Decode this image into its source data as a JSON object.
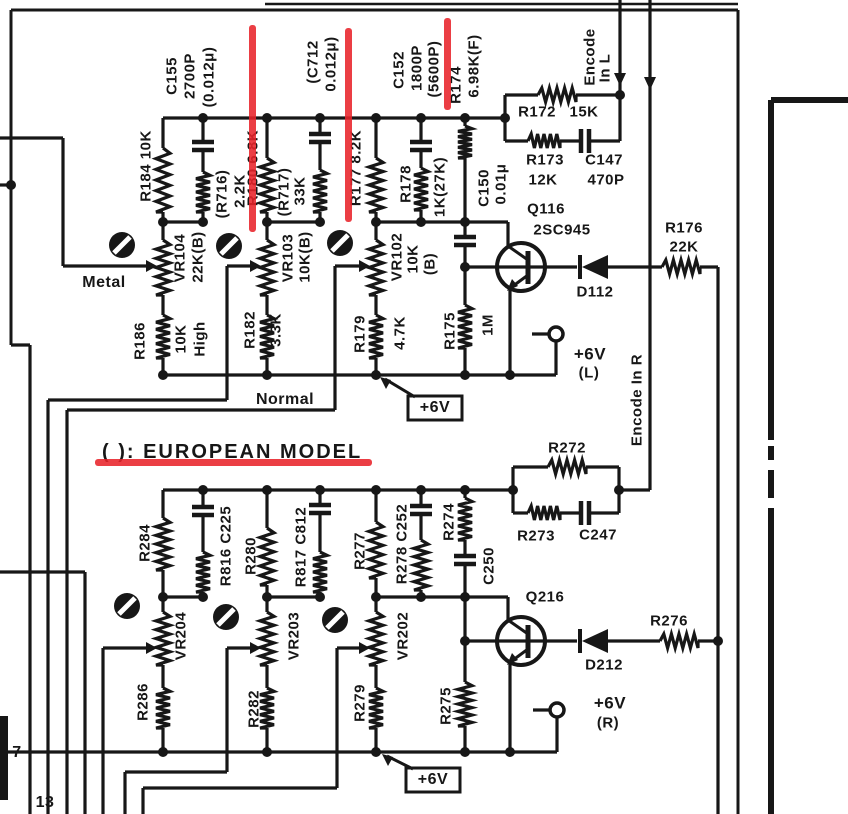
{
  "colors": {
    "ink": "#171717",
    "paper": "#ffffff",
    "annotation": "#e8232a"
  },
  "note": "( ): EUROPEAN MODEL",
  "channel_left": {
    "transistor": "Q116 2SC945",
    "diode": "D112",
    "supply": "+6V (L)",
    "encode_line": "Encode In L",
    "selector_positions": [
      "Metal",
      "High",
      "Normal"
    ]
  },
  "channel_right": {
    "transistor": "Q216",
    "diode": "D212",
    "supply": "+6V (R)",
    "encode_line": "Encode In R"
  },
  "pins": [
    "7",
    "13"
  ],
  "labels": [
    {
      "t": "C155",
      "x": 172,
      "y": 76,
      "r": -90,
      "s": 15
    },
    {
      "t": "2700P",
      "x": 190,
      "y": 76,
      "r": -90,
      "s": 15
    },
    {
      "t": "(0.012μ)",
      "x": 209,
      "y": 77,
      "r": -90,
      "s": 15
    },
    {
      "t": "R184 10K",
      "x": 146,
      "y": 166,
      "r": -90,
      "s": 15
    },
    {
      "t": "(R716)",
      "x": 222,
      "y": 194,
      "r": -90,
      "s": 15
    },
    {
      "t": "2.2K",
      "x": 240,
      "y": 191,
      "r": -90,
      "s": 15
    },
    {
      "t": "R180 6.8K",
      "x": 253,
      "y": 168,
      "r": -90,
      "s": 15
    },
    {
      "t": "(R717)",
      "x": 284,
      "y": 192,
      "r": -90,
      "s": 15
    },
    {
      "t": "33K",
      "x": 300,
      "y": 191,
      "r": -90,
      "s": 15
    },
    {
      "t": "(C712",
      "x": 313,
      "y": 62,
      "r": -90,
      "s": 15
    },
    {
      "t": "0.012μ)",
      "x": 331,
      "y": 64,
      "r": -90,
      "s": 15
    },
    {
      "t": "R177 8.2K",
      "x": 356,
      "y": 168,
      "r": -90,
      "s": 15
    },
    {
      "t": "C152",
      "x": 399,
      "y": 70,
      "r": -90,
      "s": 15
    },
    {
      "t": "1800P",
      "x": 417,
      "y": 68,
      "r": -90,
      "s": 15
    },
    {
      "t": "(5600P)",
      "x": 434,
      "y": 69,
      "r": -90,
      "s": 15
    },
    {
      "t": "R174",
      "x": 456,
      "y": 85,
      "r": -90,
      "s": 15
    },
    {
      "t": "6.98K(F)",
      "x": 474,
      "y": 66,
      "r": -90,
      "s": 15
    },
    {
      "t": "R178",
      "x": 406,
      "y": 184,
      "r": -90,
      "s": 15
    },
    {
      "t": "1K(27K)",
      "x": 440,
      "y": 187,
      "r": -90,
      "s": 15
    },
    {
      "t": "C150",
      "x": 484,
      "y": 188,
      "r": -90,
      "s": 15
    },
    {
      "t": "0.01μ",
      "x": 501,
      "y": 184,
      "r": -90,
      "s": 15
    },
    {
      "t": "VR104",
      "x": 180,
      "y": 258,
      "r": -90,
      "s": 15
    },
    {
      "t": "22K(B)",
      "x": 198,
      "y": 257,
      "r": -90,
      "s": 15
    },
    {
      "t": "VR103",
      "x": 288,
      "y": 258,
      "r": -90,
      "s": 15
    },
    {
      "t": "10K(B)",
      "x": 305,
      "y": 257,
      "r": -90,
      "s": 15
    },
    {
      "t": "VR102",
      "x": 397,
      "y": 257,
      "r": -90,
      "s": 15
    },
    {
      "t": "10K",
      "x": 413,
      "y": 259,
      "r": -90,
      "s": 15
    },
    {
      "t": "(B)",
      "x": 430,
      "y": 264,
      "r": -90,
      "s": 15
    },
    {
      "t": "R186",
      "x": 140,
      "y": 341,
      "r": -90,
      "s": 15
    },
    {
      "t": "10K",
      "x": 181,
      "y": 339,
      "r": -90,
      "s": 15
    },
    {
      "t": "High",
      "x": 200,
      "y": 339,
      "r": -90,
      "s": 15
    },
    {
      "t": "R182",
      "x": 250,
      "y": 330,
      "r": -90,
      "s": 15
    },
    {
      "t": "3.3K",
      "x": 276,
      "y": 330,
      "r": -90,
      "s": 15
    },
    {
      "t": "R179",
      "x": 360,
      "y": 334,
      "r": -90,
      "s": 15
    },
    {
      "t": "4.7K",
      "x": 400,
      "y": 333,
      "r": -90,
      "s": 15
    },
    {
      "t": "R175",
      "x": 450,
      "y": 331,
      "r": -90,
      "s": 15
    },
    {
      "t": "1M",
      "x": 488,
      "y": 325,
      "r": -90,
      "s": 15
    },
    {
      "t": "Encode",
      "x": 590,
      "y": 57,
      "r": -90,
      "s": 15
    },
    {
      "t": "In L",
      "x": 605,
      "y": 68,
      "r": -90,
      "s": 15
    },
    {
      "t": "Encode In R",
      "x": 637,
      "y": 400,
      "r": -90,
      "s": 15
    },
    {
      "t": "R284",
      "x": 145,
      "y": 543,
      "r": -90,
      "s": 15
    },
    {
      "t": "R816 C225",
      "x": 226,
      "y": 546,
      "r": -90,
      "s": 15
    },
    {
      "t": "R280",
      "x": 251,
      "y": 556,
      "r": -90,
      "s": 15
    },
    {
      "t": "R817 C812",
      "x": 301,
      "y": 547,
      "r": -90,
      "s": 15
    },
    {
      "t": "R277",
      "x": 360,
      "y": 551,
      "r": -90,
      "s": 15
    },
    {
      "t": "R278 C252",
      "x": 402,
      "y": 544,
      "r": -90,
      "s": 15
    },
    {
      "t": "R274",
      "x": 449,
      "y": 522,
      "r": -90,
      "s": 15
    },
    {
      "t": "C250",
      "x": 489,
      "y": 566,
      "r": -90,
      "s": 15
    },
    {
      "t": "VR204",
      "x": 181,
      "y": 636,
      "r": -90,
      "s": 15
    },
    {
      "t": "VR203",
      "x": 294,
      "y": 636,
      "r": -90,
      "s": 15
    },
    {
      "t": "VR202",
      "x": 403,
      "y": 636,
      "r": -90,
      "s": 15
    },
    {
      "t": "R286",
      "x": 143,
      "y": 702,
      "r": -90,
      "s": 15
    },
    {
      "t": "R282",
      "x": 254,
      "y": 709,
      "r": -90,
      "s": 15
    },
    {
      "t": "R279",
      "x": 360,
      "y": 703,
      "r": -90,
      "s": 15
    },
    {
      "t": "R275",
      "x": 446,
      "y": 706,
      "r": -90,
      "s": 15
    },
    {
      "t": "Metal",
      "x": 104,
      "y": 283,
      "r": 0,
      "s": 16
    },
    {
      "t": "Normal",
      "x": 285,
      "y": 400,
      "r": 0,
      "s": 16
    },
    {
      "t": "R172",
      "x": 537,
      "y": 112,
      "r": 0,
      "s": 15
    },
    {
      "t": "15K",
      "x": 584,
      "y": 112,
      "r": 0,
      "s": 15
    },
    {
      "t": "R173",
      "x": 545,
      "y": 160,
      "r": 0,
      "s": 15
    },
    {
      "t": "12K",
      "x": 543,
      "y": 180,
      "r": 0,
      "s": 15
    },
    {
      "t": "C147",
      "x": 604,
      "y": 160,
      "r": 0,
      "s": 15
    },
    {
      "t": "470P",
      "x": 606,
      "y": 180,
      "r": 0,
      "s": 15
    },
    {
      "t": "Q116",
      "x": 546,
      "y": 209,
      "r": 0,
      "s": 15
    },
    {
      "t": "2SC945",
      "x": 562,
      "y": 230,
      "r": 0,
      "s": 15
    },
    {
      "t": "D112",
      "x": 595,
      "y": 292,
      "r": 0,
      "s": 15
    },
    {
      "t": "R176",
      "x": 684,
      "y": 228,
      "r": 0,
      "s": 15
    },
    {
      "t": "22K",
      "x": 684,
      "y": 247,
      "r": 0,
      "s": 15
    },
    {
      "t": "+6V",
      "x": 590,
      "y": 354,
      "r": 0,
      "s": 17
    },
    {
      "t": "(L)",
      "x": 589,
      "y": 373,
      "r": 0,
      "s": 15
    },
    {
      "t": "( ): EUROPEAN MODEL",
      "x": 102,
      "y": 452,
      "r": 0,
      "s": 20,
      "a": "left",
      "ls": 2
    },
    {
      "t": "R272",
      "x": 567,
      "y": 448,
      "r": 0,
      "s": 15
    },
    {
      "t": "R273",
      "x": 536,
      "y": 536,
      "r": 0,
      "s": 15
    },
    {
      "t": "C247",
      "x": 598,
      "y": 535,
      "r": 0,
      "s": 15
    },
    {
      "t": "Q216",
      "x": 545,
      "y": 597,
      "r": 0,
      "s": 15
    },
    {
      "t": "D212",
      "x": 604,
      "y": 665,
      "r": 0,
      "s": 15
    },
    {
      "t": "R276",
      "x": 669,
      "y": 621,
      "r": 0,
      "s": 15
    },
    {
      "t": "+6V",
      "x": 610,
      "y": 703,
      "r": 0,
      "s": 17
    },
    {
      "t": "(R)",
      "x": 608,
      "y": 723,
      "r": 0,
      "s": 15
    },
    {
      "t": "+6V",
      "x": 435,
      "y": 408,
      "r": 0,
      "s": 16
    },
    {
      "t": "+6V",
      "x": 433,
      "y": 780,
      "r": 0,
      "s": 16
    },
    {
      "t": "7",
      "x": 17,
      "y": 753,
      "r": 0,
      "s": 16
    },
    {
      "t": "13",
      "x": 45,
      "y": 803,
      "r": 0,
      "s": 16
    }
  ],
  "annotations": {
    "color": "#e8232a",
    "marks": [
      {
        "x": 249,
        "y": 25,
        "w": 7,
        "h": 207
      },
      {
        "x": 345,
        "y": 28,
        "w": 7,
        "h": 194
      },
      {
        "x": 444,
        "y": 18,
        "w": 7,
        "h": 92
      },
      {
        "x": 95,
        "y": 459,
        "w": 277,
        "h": 7
      }
    ]
  }
}
